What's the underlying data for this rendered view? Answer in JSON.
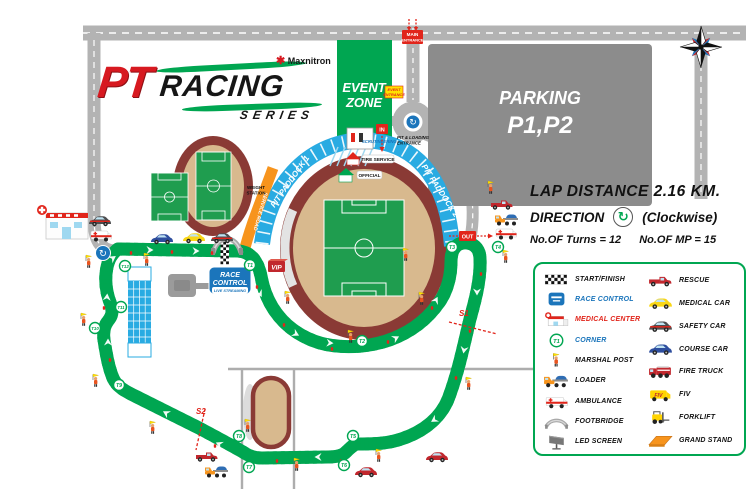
{
  "colors": {
    "track_green": "#00A651",
    "paddock_blue": "#29ABE2",
    "field_green": "#1F9D4F",
    "stadium_maroon": "#8A3A35",
    "stadium_tan": "#D8B98E",
    "road_gray": "#B3B3B3",
    "parking_gray": "#8C8C8C",
    "accent_red": "#E1251B",
    "signal_yellow": "#FFE100",
    "orange": "#F7941D",
    "control_blue": "#1B75BB"
  },
  "logo": {
    "pt": "PT",
    "racing": "RACING",
    "series": "SERIES",
    "brand": "Maxnitron",
    "flower": "✱"
  },
  "zones": {
    "event_zone_l1": "EVENT",
    "event_zone_l2": "ZONE",
    "parking_l1": "PARKING",
    "parking_l2": "P1,P2"
  },
  "signs": {
    "main_entrance_l1": "MAIN",
    "main_entrance_l2": "ENTRANCE",
    "event_entrance_l1": "EVENT",
    "event_entrance_l2": "ENTRANCE",
    "pit_loading_l1": "PIT & LOADING",
    "pit_loading_l2": "ENTRANCE",
    "in": "IN",
    "out": "OUT",
    "scrutineering": "SCRUTINEERING",
    "weight_l1": "WEIGHT",
    "weight_l2": "STATION",
    "service_road": "SERVICE ROAD",
    "vip": "VIP",
    "tire_service": "TIRE SERVICE",
    "official": "OFFICIAL",
    "pit_paddock_1": "PIT PADDOCK 1",
    "pit_paddock_2": "PIT PADDOCK 2",
    "race_control_l1": "RACE",
    "race_control_l2": "CONTROL",
    "live_streaming": "LIVE STREAMING",
    "roundabout_glyph": "↻",
    "direction_glyph": "↻"
  },
  "info": {
    "lap_distance": "LAP DISTANCE 2.16 KM.",
    "direction_label": "DIRECTION",
    "direction_value": "(Clockwise)",
    "turns": "No.OF Turns = 12",
    "marshal_posts": "No.OF MP = 15"
  },
  "track": {
    "corners": [
      {
        "label": "T1",
        "x": 250,
        "y": 265
      },
      {
        "label": "T2",
        "x": 362,
        "y": 341
      },
      {
        "label": "T3",
        "x": 452,
        "y": 247
      },
      {
        "label": "T4",
        "x": 498,
        "y": 247
      },
      {
        "label": "T5",
        "x": 353,
        "y": 436
      },
      {
        "label": "T6",
        "x": 344,
        "y": 465
      },
      {
        "label": "T7",
        "x": 249,
        "y": 467
      },
      {
        "label": "T8",
        "x": 239,
        "y": 436
      },
      {
        "label": "T9",
        "x": 119,
        "y": 385
      },
      {
        "label": "T10",
        "x": 95,
        "y": 328
      },
      {
        "label": "T11",
        "x": 121,
        "y": 307
      },
      {
        "label": "T12",
        "x": 125,
        "y": 266
      }
    ],
    "sectors": [
      {
        "label": "S1",
        "x1": 449,
        "y1": 322,
        "x2": 497,
        "y2": 334,
        "lx": 459,
        "ly": 316
      },
      {
        "label": "S2",
        "x1": 205,
        "y1": 409,
        "x2": 196,
        "y2": 450,
        "lx": 196,
        "ly": 414
      }
    ],
    "marshals": [
      [
        88,
        266
      ],
      [
        146,
        264
      ],
      [
        83,
        324
      ],
      [
        95,
        385
      ],
      [
        152,
        432
      ],
      [
        296,
        469
      ],
      [
        350,
        341
      ],
      [
        287,
        302
      ],
      [
        405,
        259
      ],
      [
        505,
        261
      ],
      [
        421,
        303
      ],
      [
        468,
        388
      ],
      [
        490,
        192
      ],
      [
        378,
        460
      ],
      [
        247,
        430
      ]
    ],
    "chevrons": [
      [
        150,
        250,
        90
      ],
      [
        196,
        251,
        90
      ],
      [
        260,
        294,
        150
      ],
      [
        296,
        334,
        118
      ],
      [
        330,
        343,
        95
      ],
      [
        396,
        338,
        62
      ],
      [
        436,
        300,
        28
      ],
      [
        477,
        292,
        180
      ],
      [
        464,
        350,
        190
      ],
      [
        434,
        420,
        237
      ],
      [
        318,
        457,
        270
      ],
      [
        219,
        444,
        295
      ],
      [
        166,
        413,
        300
      ],
      [
        108,
        342,
        0
      ],
      [
        107,
        297,
        5
      ],
      [
        113,
        258,
        55
      ]
    ],
    "extinguishers": [
      [
        131,
        253
      ],
      [
        172,
        252
      ],
      [
        212,
        253
      ],
      [
        257,
        287
      ],
      [
        284,
        325
      ],
      [
        332,
        349
      ],
      [
        388,
        342
      ],
      [
        432,
        308
      ],
      [
        481,
        274
      ],
      [
        470,
        331
      ],
      [
        456,
        378
      ],
      [
        341,
        461
      ],
      [
        277,
        461
      ],
      [
        215,
        446
      ],
      [
        110,
        360
      ],
      [
        104,
        308
      ]
    ]
  },
  "vehicles": [
    {
      "type": "coursecar",
      "x": 162,
      "y": 239
    },
    {
      "type": "medicalcar",
      "x": 194,
      "y": 238
    },
    {
      "type": "safetycar",
      "x": 222,
      "y": 238
    },
    {
      "type": "safetycar",
      "x": 100,
      "y": 221
    },
    {
      "type": "ambulance",
      "x": 101,
      "y": 235
    },
    {
      "type": "rescue",
      "x": 502,
      "y": 204
    },
    {
      "type": "loader",
      "x": 507,
      "y": 219
    },
    {
      "type": "ambulance",
      "x": 506,
      "y": 233
    },
    {
      "type": "rescue",
      "x": 207,
      "y": 456
    },
    {
      "type": "loader",
      "x": 217,
      "y": 471
    },
    {
      "type": "redcar",
      "x": 366,
      "y": 472
    },
    {
      "type": "redcar",
      "x": 437,
      "y": 457
    }
  ],
  "legend": {
    "fiv_badge": "FIV",
    "left": [
      {
        "icon": "startfinish",
        "label": "START/FINISH"
      },
      {
        "icon": "racecontrol",
        "label": "RACE CONTROL",
        "color": "#1B75BB"
      },
      {
        "icon": "medcenter",
        "label": "MEDICAL CENTER",
        "color": "#E1251B"
      },
      {
        "icon": "corner",
        "label": "CORNER",
        "color": "#1B75BB"
      },
      {
        "icon": "marshal",
        "label": "MARSHAL POST"
      },
      {
        "icon": "loader",
        "label": "LOADER"
      },
      {
        "icon": "ambulance",
        "label": "AMBULANCE"
      },
      {
        "icon": "footbridge",
        "label": "FOOTBRIDGE"
      },
      {
        "icon": "ledscreen",
        "label": "LED SCREEN"
      }
    ],
    "right": [
      {
        "icon": "rescue",
        "label": "RESCUE"
      },
      {
        "icon": "medicalcar",
        "label": "MEDICAL CAR"
      },
      {
        "icon": "safetycar",
        "label": "SAFETY CAR"
      },
      {
        "icon": "coursecar",
        "label": "COURSE CAR"
      },
      {
        "icon": "firetruck",
        "label": "FIRE TRUCK"
      },
      {
        "icon": "fiv",
        "label": "FIV"
      },
      {
        "icon": "forklift",
        "label": "FORKLIFT"
      },
      {
        "icon": "grandstand",
        "label": "GRAND STAND"
      }
    ]
  }
}
